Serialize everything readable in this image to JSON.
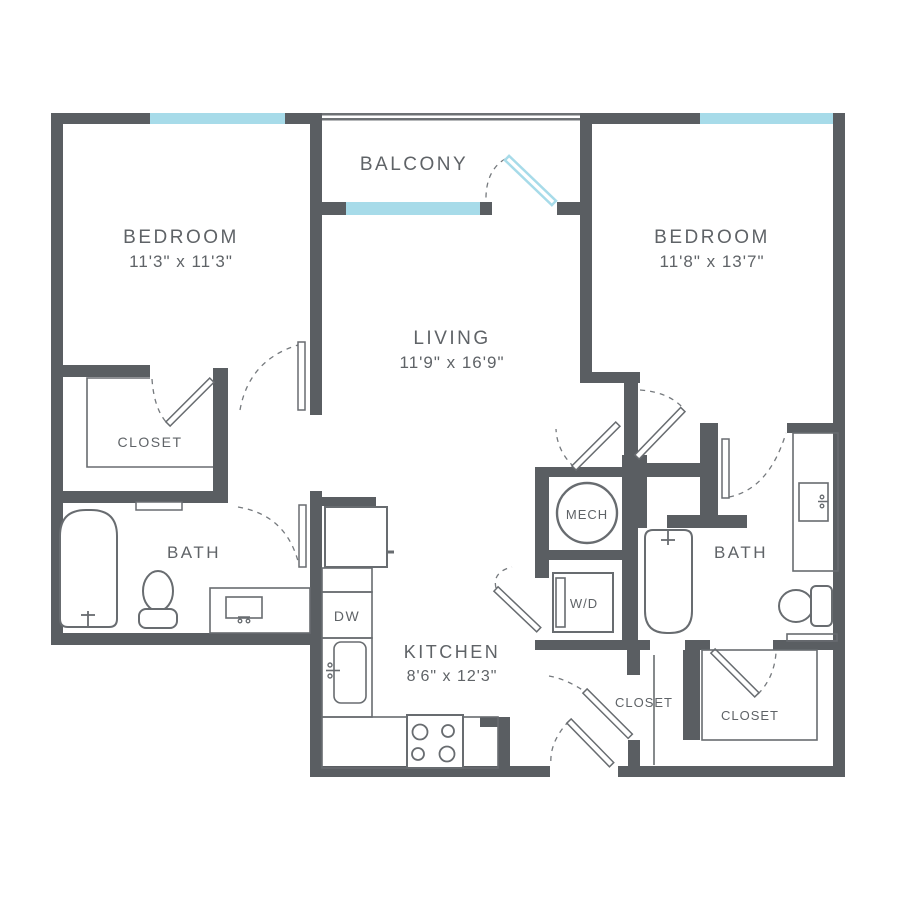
{
  "colors": {
    "wall": "#5a5e62",
    "window": "#a7dbe9",
    "fixture_line": "#686c70",
    "text": "#5f6367",
    "background": "#ffffff"
  },
  "rooms": {
    "bedroom_left": {
      "name": "BEDROOM",
      "dimensions": "11'3\" x 11'3\""
    },
    "bedroom_right": {
      "name": "BEDROOM",
      "dimensions": "11'8\" x 13'7\""
    },
    "living": {
      "name": "LIVING",
      "dimensions": "11'9\" x 16'9\""
    },
    "kitchen": {
      "name": "KITCHEN",
      "dimensions": "8'6\" x 12'3\""
    },
    "balcony": {
      "name": "BALCONY"
    },
    "bath_left": {
      "name": "BATH"
    },
    "bath_right": {
      "name": "BATH"
    },
    "closet_bedroom_left": {
      "name": "CLOSET"
    },
    "closet_hall": {
      "name": "CLOSET"
    },
    "closet_bedroom_right": {
      "name": "CLOSET"
    },
    "mechanical": {
      "name": "MECH"
    },
    "washer_dryer": {
      "name": "W/D"
    },
    "dishwasher": {
      "name": "DW"
    }
  },
  "fixtures": {
    "left_bath": [
      "bathtub",
      "toilet",
      "vanity-sink"
    ],
    "right_bath": [
      "bathtub",
      "toilet",
      "vanity-sink"
    ],
    "kitchen": [
      "refrigerator",
      "dishwasher",
      "sink",
      "stove-4-burner"
    ],
    "laundry": [
      "washer-dryer"
    ]
  },
  "windows": {
    "count": 3,
    "balcony_railing": true,
    "balcony_door": "glass-door"
  }
}
